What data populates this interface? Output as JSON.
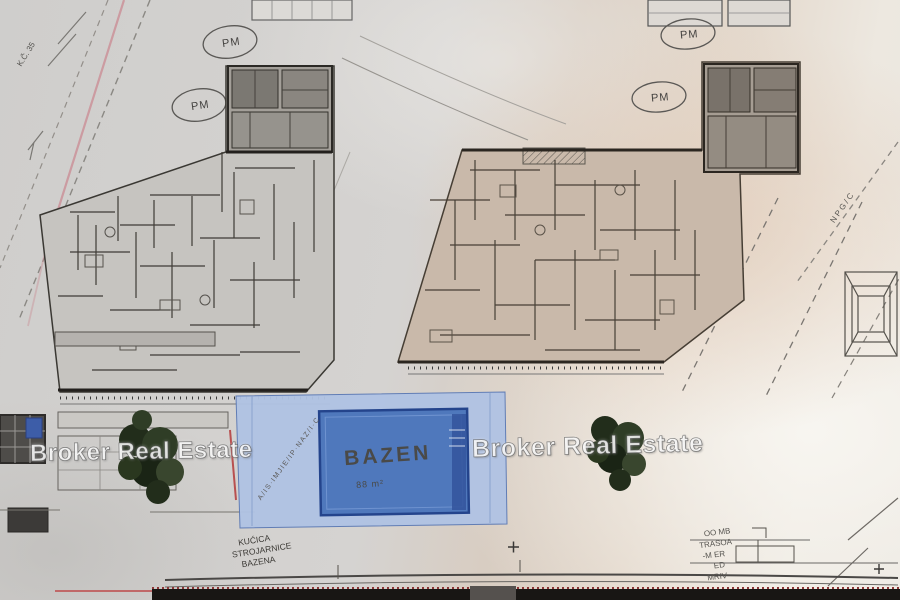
{
  "watermark": {
    "text": "Broker Real Estate"
  },
  "pool": {
    "label": "BAZEN",
    "area_text": "88 m²"
  },
  "parking": {
    "label": "PM"
  },
  "labels": {
    "machinery_line1": "KUĆICA",
    "machinery_line2": "STROJARNICE",
    "machinery_line3": "BAZENA",
    "right_note_line1": "OO MB",
    "right_note_line2": "TRASOA",
    "right_note_line3": "-M ER",
    "right_note_line4": "ED",
    "right_note_line5": "MRIV",
    "parcel_note": "K.Č. 35",
    "road_note": "A/IS·IMJIE/IP·NAZ/I·C",
    "boundary_note": "N P G / C"
  },
  "colors": {
    "pool_water": "#4f78bc",
    "pool_deck": "#b0c3e4",
    "pool_text": "#16307e",
    "tree_green": "#2a371f",
    "boundary_pink": "#c98a92",
    "paper_gray": "#d3d2d0",
    "paper_tan": "#d9c3b0"
  }
}
